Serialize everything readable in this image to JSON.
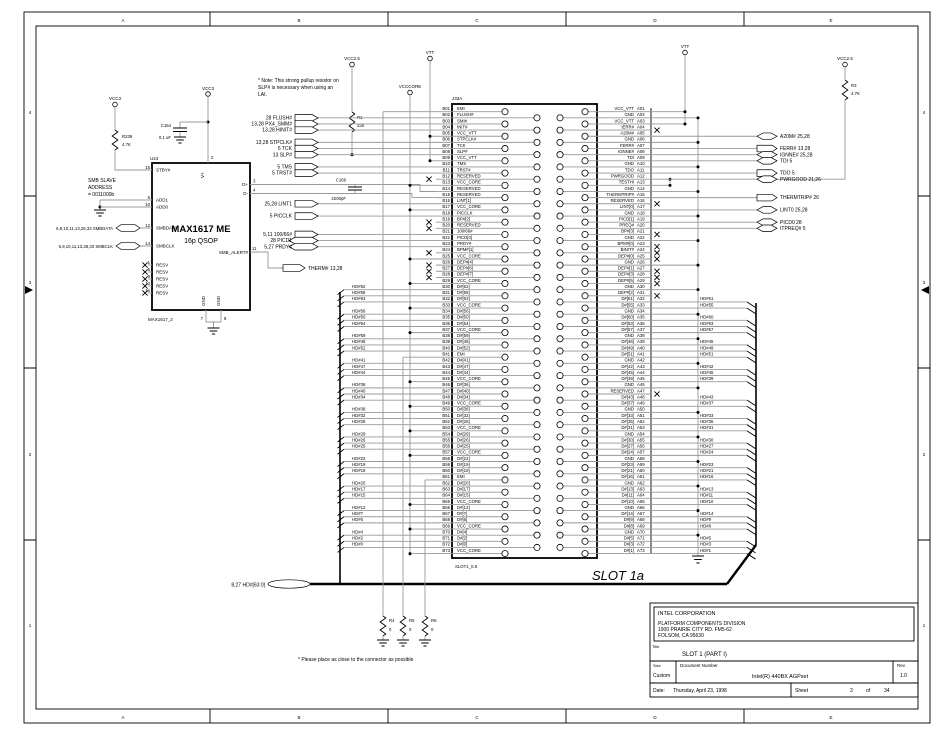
{
  "zones": {
    "top": [
      "A",
      "B",
      "C",
      "D",
      "E"
    ],
    "bottom": [
      "A",
      "B",
      "C",
      "D",
      "E"
    ],
    "left": [
      "4",
      "3",
      "2",
      "1"
    ],
    "right": [
      "4",
      "3",
      "2",
      "1"
    ]
  },
  "power_labels": {
    "vcc3_left": "VCC3",
    "vcc3_mid": "VCC3",
    "vcc25_r1": "VCC2.5",
    "vcccore": "VCCCORE",
    "vtt_left": "VTT",
    "vtt_right": "VTT",
    "vcc25_r3": "VCC2.5"
  },
  "components": {
    "r239": {
      "ref": "R239",
      "value": "4.7K"
    },
    "r1": {
      "ref": "R1",
      "value": "330"
    },
    "r3": {
      "ref": "R3",
      "value": "4.7K"
    },
    "r4": {
      "ref": "R4",
      "value": "0"
    },
    "r5": {
      "ref": "R5",
      "value": "0"
    },
    "r6": {
      "ref": "R6",
      "value": "0"
    },
    "c164": {
      "ref": "C164",
      "value": "0.1 uF"
    },
    "c166": {
      "ref": "C166",
      "value": "2200pF"
    }
  },
  "max1617": {
    "refdes": "U24",
    "title": "MAX1617 ME",
    "subtitle": "16p QSOP",
    "footer": "MAX1617_2",
    "top_pin": {
      "num": "2",
      "name": "V+"
    },
    "left_pins": [
      {
        "num": "15",
        "name": "STBY#"
      },
      {
        "num": "6",
        "name": "ADD1"
      },
      {
        "num": "10",
        "name": "ADD0"
      },
      {
        "num": "12",
        "name": "SMBDATA"
      },
      {
        "num": "14",
        "name": "SMBCLK"
      },
      {
        "num": "1",
        "name": "RESV"
      },
      {
        "num": "5",
        "name": "RESV"
      },
      {
        "num": "9",
        "name": "RESV"
      },
      {
        "num": "13",
        "name": "RESV"
      },
      {
        "num": "16",
        "name": "RESV"
      }
    ],
    "right_pins": [
      {
        "num": "3",
        "name": "D+"
      },
      {
        "num": "4",
        "name": "D-"
      },
      {
        "num": "11",
        "name": "SMB_ALERT#"
      }
    ],
    "bottom_pins": [
      {
        "num": "7",
        "name": "GND"
      },
      {
        "num": "8",
        "name": "GND"
      }
    ]
  },
  "left_labels": {
    "smb_address": [
      "SMB SLAVE",
      "ADDRESS",
      "= 0011000b"
    ],
    "smbdata": "6,9,10,11,13,28,33  SMBDATA",
    "smbclk": "6,9,10,11,13,28,33  SMBCLK"
  },
  "therm_flag": "THERM#  13,28",
  "notes": {
    "top": [
      "* Note:  This strong pullup resistor on",
      "SLP# is necessary when using an",
      "LAI."
    ],
    "bottom": "* Please place as close to the connector as possible"
  },
  "hd_bus_label": "8,27  HD#[63:0]",
  "connector": {
    "refdes": "J33A",
    "slot_label": "SLOT 1a",
    "footprint": "SLOT1_0.8",
    "b_pins": [
      {
        "p": "B01",
        "n": "EMI"
      },
      {
        "p": "B02",
        "n": "FLUSH#"
      },
      {
        "p": "B03",
        "n": "SMI#"
      },
      {
        "p": "B04",
        "n": "INIT#"
      },
      {
        "p": "B05",
        "n": "VCC_VTT"
      },
      {
        "p": "B06",
        "n": "STPCLK#"
      },
      {
        "p": "B07",
        "n": "TCK"
      },
      {
        "p": "B08",
        "n": "SLP#"
      },
      {
        "p": "B09",
        "n": "VCC_VTT"
      },
      {
        "p": "B10",
        "n": "TMS"
      },
      {
        "p": "B11",
        "n": "TRST#"
      },
      {
        "p": "B12",
        "n": "RESERVED",
        "x": 1
      },
      {
        "p": "B13",
        "n": "VCC_CORE"
      },
      {
        "p": "B14",
        "n": "RESERVED"
      },
      {
        "p": "B15",
        "n": "RESERVED"
      },
      {
        "p": "B16",
        "n": "LINT[1]"
      },
      {
        "p": "B17",
        "n": "VCC_CORE"
      },
      {
        "p": "B18",
        "n": "PICCLK"
      },
      {
        "p": "B19",
        "n": "BP#[2]",
        "x": 1
      },
      {
        "p": "B20",
        "n": "RESERVED",
        "x": 1
      },
      {
        "p": "B21",
        "n": "100/66#"
      },
      {
        "p": "B22",
        "n": "PICD[0]"
      },
      {
        "p": "B23",
        "n": "PRDY#"
      },
      {
        "p": "B24",
        "n": "BPM#[1]",
        "x": 1
      },
      {
        "p": "B25",
        "n": "VCC_CORE"
      },
      {
        "p": "B26",
        "n": "DEP#[4]",
        "x": 1
      },
      {
        "p": "B27",
        "n": "DEP#[6]",
        "x": 1
      },
      {
        "p": "B28",
        "n": "DEP#[7]",
        "x": 1
      },
      {
        "p": "B29",
        "n": "VCC_CORE"
      },
      {
        "p": "B30",
        "n": "D#[62]",
        "hd": "HD#62"
      },
      {
        "p": "B31",
        "n": "D#[58]",
        "hd": "HD#58"
      },
      {
        "p": "B32",
        "n": "D#[63]",
        "hd": "HD#63"
      },
      {
        "p": "B33",
        "n": "VCC_CORE"
      },
      {
        "p": "B34",
        "n": "D#[56]",
        "hd": "HD#56"
      },
      {
        "p": "B35",
        "n": "D#[50]",
        "hd": "HD#50"
      },
      {
        "p": "B36",
        "n": "D#[54]",
        "hd": "HD#54"
      },
      {
        "p": "B37",
        "n": "VCC_CORE"
      },
      {
        "p": "B38",
        "n": "D#[59]",
        "hd": "HD#59"
      },
      {
        "p": "B39",
        "n": "D#[48]",
        "hd": "HD#48"
      },
      {
        "p": "B40",
        "n": "D#[52]",
        "hd": "HD#52"
      },
      {
        "p": "B41",
        "n": "EMI"
      },
      {
        "p": "B42",
        "n": "D#[41]",
        "hd": "HD#41"
      },
      {
        "p": "B43",
        "n": "D#[47]",
        "hd": "HD#47"
      },
      {
        "p": "B44",
        "n": "D#[44]",
        "hd": "HD#44"
      },
      {
        "p": "B45",
        "n": "VCC_CORE"
      },
      {
        "p": "B46",
        "n": "D#[36]",
        "hd": "HD#36"
      },
      {
        "p": "B47",
        "n": "D#[40]",
        "hd": "HD#40"
      },
      {
        "p": "B48",
        "n": "D#[34]",
        "hd": "HD#34"
      },
      {
        "p": "B49",
        "n": "VCC_CORE"
      },
      {
        "p": "B50",
        "n": "D#[38]",
        "hd": "HD#38"
      },
      {
        "p": "B51",
        "n": "D#[32]",
        "hd": "HD#32"
      },
      {
        "p": "B52",
        "n": "D#[28]",
        "hd": "HD#28"
      },
      {
        "p": "B53",
        "n": "VCC_CORE"
      },
      {
        "p": "B54",
        "n": "D#[29]",
        "hd": "HD#29"
      },
      {
        "p": "B55",
        "n": "D#[26]",
        "hd": "HD#26"
      },
      {
        "p": "B56",
        "n": "D#[25]",
        "hd": "HD#25"
      },
      {
        "p": "B57",
        "n": "VCC_CORE"
      },
      {
        "p": "B58",
        "n": "D#[22]",
        "hd": "HD#22"
      },
      {
        "p": "B59",
        "n": "D#[19]",
        "hd": "HD#19"
      },
      {
        "p": "B60",
        "n": "D#[18]",
        "hd": "HD#18"
      },
      {
        "p": "B61",
        "n": "EMI"
      },
      {
        "p": "B62",
        "n": "D#[20]",
        "hd": "HD#20"
      },
      {
        "p": "B63",
        "n": "D#[17]",
        "hd": "HD#17"
      },
      {
        "p": "B64",
        "n": "D#[15]",
        "hd": "HD#15"
      },
      {
        "p": "B65",
        "n": "VCC_CORE"
      },
      {
        "p": "B66",
        "n": "D#[12]",
        "hd": "HD#12"
      },
      {
        "p": "B67",
        "n": "D#[7]",
        "hd": "HD#7"
      },
      {
        "p": "B68",
        "n": "D#[6]",
        "hd": "HD#6"
      },
      {
        "p": "B69",
        "n": "VCC_CORE"
      },
      {
        "p": "B70",
        "n": "D#[4]",
        "hd": "HD#4"
      },
      {
        "p": "B71",
        "n": "D#[2]",
        "hd": "HD#2"
      },
      {
        "p": "B72",
        "n": "D#[0]",
        "hd": "HD#0"
      },
      {
        "p": "B73",
        "n": "VCC_CORE"
      }
    ],
    "a_pins": [
      {
        "p": "A01",
        "n": "VCC_VTT"
      },
      {
        "p": "A02",
        "n": "GND"
      },
      {
        "p": "A03",
        "n": "VCC_VTT"
      },
      {
        "p": "A04",
        "n": "IERR#",
        "x": 1
      },
      {
        "p": "A05",
        "n": "A20M#"
      },
      {
        "p": "A06",
        "n": "GND"
      },
      {
        "p": "A07",
        "n": "FERR#"
      },
      {
        "p": "A08",
        "n": "IGNNE#"
      },
      {
        "p": "A09",
        "n": "TDI"
      },
      {
        "p": "A10",
        "n": "GND"
      },
      {
        "p": "A11",
        "n": "TDO"
      },
      {
        "p": "A12",
        "n": "PWRGOOD"
      },
      {
        "p": "A13",
        "n": "TESTHI"
      },
      {
        "p": "A14",
        "n": "GND"
      },
      {
        "p": "A15",
        "n": "THERMTRIP#"
      },
      {
        "p": "A16",
        "n": "RESERVED",
        "x": 1
      },
      {
        "p": "A17",
        "n": "LINT[0]"
      },
      {
        "p": "A18",
        "n": "GND"
      },
      {
        "p": "A19",
        "n": "PICD[1]"
      },
      {
        "p": "A20",
        "n": "PREQ#"
      },
      {
        "p": "A21",
        "n": "BP#[3]",
        "x": 1
      },
      {
        "p": "A22",
        "n": "GND"
      },
      {
        "p": "A23",
        "n": "BPM#[0]",
        "x": 1
      },
      {
        "p": "A24",
        "n": "BINIT#",
        "x": 1
      },
      {
        "p": "A25",
        "n": "DEP#[0]",
        "x": 1
      },
      {
        "p": "A26",
        "n": "GND"
      },
      {
        "p": "A27",
        "n": "DEP#[1]",
        "x": 1
      },
      {
        "p": "A28",
        "n": "DEP#[3]",
        "x": 1
      },
      {
        "p": "A29",
        "n": "DEP#[5]",
        "x": 1
      },
      {
        "p": "A30",
        "n": "GND"
      },
      {
        "p": "A31",
        "n": "DEP#[2]",
        "x": 1
      },
      {
        "p": "A32",
        "n": "D#[61]",
        "hd": "HD#61"
      },
      {
        "p": "A33",
        "n": "D#[55]",
        "hd": "HD#55"
      },
      {
        "p": "A34",
        "n": "GND"
      },
      {
        "p": "A35",
        "n": "D#[60]",
        "hd": "HD#60"
      },
      {
        "p": "A36",
        "n": "D#[53]",
        "hd": "HD#53"
      },
      {
        "p": "A37",
        "n": "D#[57]",
        "hd": "HD#57"
      },
      {
        "p": "A38",
        "n": "GND"
      },
      {
        "p": "A39",
        "n": "D#[46]",
        "hd": "HD#46"
      },
      {
        "p": "A40",
        "n": "D#[49]",
        "hd": "HD#49"
      },
      {
        "p": "A41",
        "n": "D#[51]",
        "hd": "HD#51"
      },
      {
        "p": "A42",
        "n": "GND"
      },
      {
        "p": "A43",
        "n": "D#[42]",
        "hd": "HD#42"
      },
      {
        "p": "A44",
        "n": "D#[45]",
        "hd": "HD#45"
      },
      {
        "p": "A45",
        "n": "D#[39]",
        "hd": "HD#39"
      },
      {
        "p": "A46",
        "n": "GND"
      },
      {
        "p": "A47",
        "n": "RESERVED",
        "x": 1
      },
      {
        "p": "A48",
        "n": "D#[43]",
        "hd": "HD#43"
      },
      {
        "p": "A49",
        "n": "D#[37]",
        "hd": "HD#37"
      },
      {
        "p": "A50",
        "n": "GND"
      },
      {
        "p": "A51",
        "n": "D#[33]",
        "hd": "HD#33"
      },
      {
        "p": "A52",
        "n": "D#[35]",
        "hd": "HD#35"
      },
      {
        "p": "A53",
        "n": "D#[31]",
        "hd": "HD#31"
      },
      {
        "p": "A54",
        "n": "GND"
      },
      {
        "p": "A55",
        "n": "D#[30]",
        "hd": "HD#30"
      },
      {
        "p": "A56",
        "n": "D#[27]",
        "hd": "HD#27"
      },
      {
        "p": "A57",
        "n": "D#[24]",
        "hd": "HD#24"
      },
      {
        "p": "A58",
        "n": "GND"
      },
      {
        "p": "A59",
        "n": "D#[23]",
        "hd": "HD#23"
      },
      {
        "p": "A60",
        "n": "D#[21]",
        "hd": "HD#21"
      },
      {
        "p": "A61",
        "n": "D#[16]",
        "hd": "HD#16"
      },
      {
        "p": "A62",
        "n": "GND"
      },
      {
        "p": "A63",
        "n": "D#[13]",
        "hd": "HD#13"
      },
      {
        "p": "A64",
        "n": "D#[11]",
        "hd": "HD#11"
      },
      {
        "p": "A65",
        "n": "D#[10]",
        "hd": "HD#10"
      },
      {
        "p": "A66",
        "n": "GND"
      },
      {
        "p": "A67",
        "n": "D#[14]",
        "hd": "HD#14"
      },
      {
        "p": "A68",
        "n": "D#[9]",
        "hd": "HD#9"
      },
      {
        "p": "A69",
        "n": "D#[8]",
        "hd": "HD#8"
      },
      {
        "p": "A70",
        "n": "GND"
      },
      {
        "p": "A71",
        "n": "D#[5]",
        "hd": "HD#5"
      },
      {
        "p": "A72",
        "n": "D#[3]",
        "hd": "HD#3"
      },
      {
        "p": "A73",
        "n": "D#[1]",
        "hd": "HD#1"
      }
    ]
  },
  "left_flags": [
    {
      "pin": "B02",
      "label": "28  FLUSH#",
      "type": "in"
    },
    {
      "pin": "B03",
      "label": "13,28  PX4_SMM#",
      "type": "in"
    },
    {
      "pin": "B04",
      "label": "13,28  HINIT#",
      "type": "in"
    },
    {
      "pin": "B06",
      "label": "13,28  STPCLK#",
      "type": "in"
    },
    {
      "pin": "B07",
      "label": "5  TCK",
      "type": "in"
    },
    {
      "pin": "B08",
      "label": "13  SLP#",
      "type": "in"
    },
    {
      "pin": "B10",
      "label": "5  TMS",
      "type": "in"
    },
    {
      "pin": "B11",
      "label": "5  TRST#",
      "type": "in"
    },
    {
      "pin": "B16",
      "label": "25,28  LINT1",
      "type": "in"
    },
    {
      "pin": "B18",
      "label": "5  PICCLK",
      "type": "in"
    },
    {
      "pin": "B21",
      "label": "5,11  100/66#",
      "type": "in"
    },
    {
      "pin": "B22",
      "label": "28  PICD1",
      "type": "bi"
    },
    {
      "pin": "B23",
      "label": "5,27  PRDY#",
      "type": "bi"
    }
  ],
  "right_flags": [
    {
      "pin": "A05",
      "label": "A20M#  25,28",
      "type": "bi"
    },
    {
      "pin": "A07",
      "label": "FERR#  13,28",
      "type": "out"
    },
    {
      "pin": "A08",
      "label": "IGNNE#  25,28",
      "type": "bi"
    },
    {
      "pin": "A09",
      "label": "TDI  5",
      "type": "bi"
    },
    {
      "pin": "A11",
      "label": "TDO  5",
      "type": "out"
    },
    {
      "pin": "A12",
      "label": "PWRGOOD  21,26",
      "type": "bi"
    },
    {
      "pin": "A15",
      "label": "THERMTRIP#  26",
      "type": "out"
    },
    {
      "pin": "A17",
      "label": "LINT0  25,28",
      "type": "bi"
    },
    {
      "pin": "A19",
      "label": "PICD0  28",
      "type": "bi"
    },
    {
      "pin": "A20",
      "label": "ITPREQ#  5",
      "type": "bi"
    }
  ],
  "titleblock": {
    "company": [
      "INTEL CORPORATION",
      "PLATFORM COMPONENTS DIVISION",
      "1900 PRAIRIE CITY RD. FM5-62",
      "FOLSOM, CA 95630"
    ],
    "title_label": "Title",
    "title": "SLOT 1 (PART I)",
    "size_label": "Size",
    "size": "Custom",
    "doc_label": "Document Number",
    "doc": "Intel(R) 440BX AGPset",
    "rev_label": "Rev",
    "rev": "1.0",
    "date_label": "Date:",
    "date": "Thursday, April 23, 1998",
    "sheet_label": "Sheet",
    "sheet": "3",
    "of_label": "of",
    "total": "34"
  },
  "colors": {
    "wire": "#999999",
    "line": "#000000",
    "background": "#ffffff"
  }
}
